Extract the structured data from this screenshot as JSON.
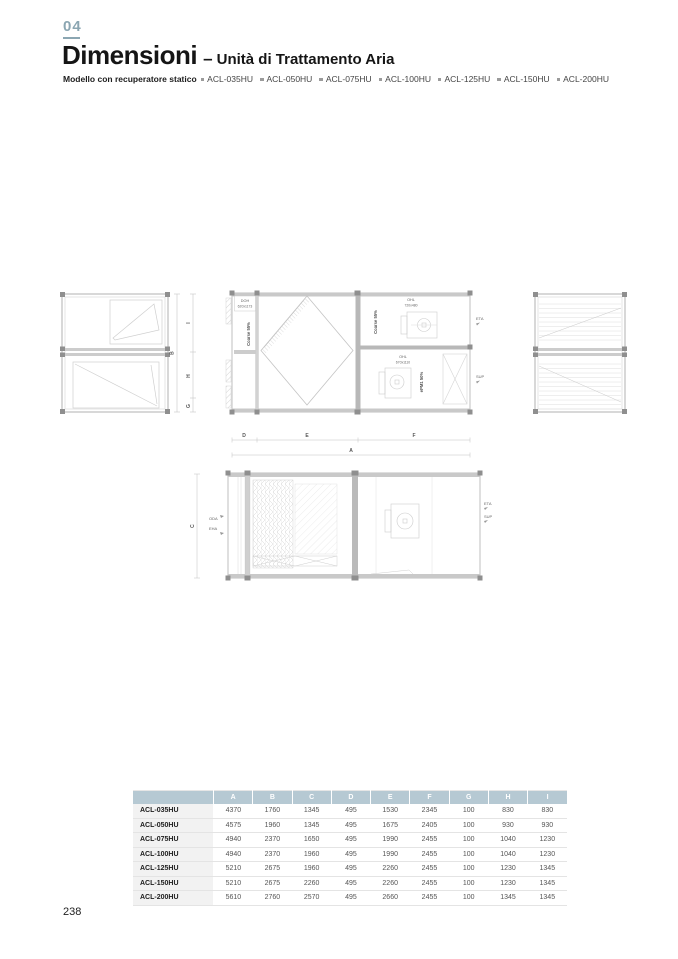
{
  "page": {
    "number": "238"
  },
  "header": {
    "chapter": "04",
    "title": "Dimensioni",
    "dash": "–",
    "subtitle": "Unità di Trattamento Aria",
    "models_label": "Modello con recuperatore statico",
    "models": [
      "ACL-035HU",
      "ACL-050HU",
      "ACL-075HU",
      "ACL-100HU",
      "ACL-125HU",
      "ACL-150HU",
      "ACL-200HU"
    ]
  },
  "drawings": {
    "front_view": {
      "dim_b": "B",
      "dim_i": "I",
      "dim_h": "H",
      "dim_g": "G"
    },
    "top_view": {
      "damper_label": "DOH",
      "damper_size": "620x1173",
      "filter_left": "Coarse 55%",
      "fan_top_label": "OHL",
      "fan_top_size": "720x480",
      "filter_right": "Coarse 55%",
      "fan_bottom_label": "OHL",
      "fan_bottom_size": "670x1110",
      "filter_fine": "ePM1 50%",
      "airflow_eta": "ETA",
      "airflow_sup": "SUP",
      "dim_d": "D",
      "dim_e": "E",
      "dim_f": "F",
      "dim_a": "A"
    },
    "side_view": {
      "airflow_oda": "ODA",
      "airflow_eha": "EHA",
      "airflow_eta": "ETA",
      "airflow_sup": "SUP",
      "dim_c": "C"
    }
  },
  "table": {
    "columns": [
      "A",
      "B",
      "C",
      "D",
      "E",
      "F",
      "G",
      "H",
      "I"
    ],
    "rows": [
      {
        "model": "ACL-035HU",
        "values": [
          "4370",
          "1760",
          "1345",
          "495",
          "1530",
          "2345",
          "100",
          "830",
          "830"
        ]
      },
      {
        "model": "ACL-050HU",
        "values": [
          "4575",
          "1960",
          "1345",
          "495",
          "1675",
          "2405",
          "100",
          "930",
          "930"
        ]
      },
      {
        "model": "ACL-075HU",
        "values": [
          "4940",
          "2370",
          "1650",
          "495",
          "1990",
          "2455",
          "100",
          "1040",
          "1230"
        ]
      },
      {
        "model": "ACL-100HU",
        "values": [
          "4940",
          "2370",
          "1960",
          "495",
          "1990",
          "2455",
          "100",
          "1040",
          "1230"
        ]
      },
      {
        "model": "ACL-125HU",
        "values": [
          "5210",
          "2675",
          "1960",
          "495",
          "2260",
          "2455",
          "100",
          "1230",
          "1345"
        ]
      },
      {
        "model": "ACL-150HU",
        "values": [
          "5210",
          "2675",
          "2260",
          "495",
          "2260",
          "2455",
          "100",
          "1230",
          "1345"
        ]
      },
      {
        "model": "ACL-200HU",
        "values": [
          "5610",
          "2760",
          "2570",
          "495",
          "2660",
          "2455",
          "100",
          "1345",
          "1345"
        ]
      }
    ]
  },
  "colors": {
    "accent": "#8ba6b2",
    "table_header_bg": "#b6c9d3",
    "model_cell_bg": "#f2f2f2"
  }
}
